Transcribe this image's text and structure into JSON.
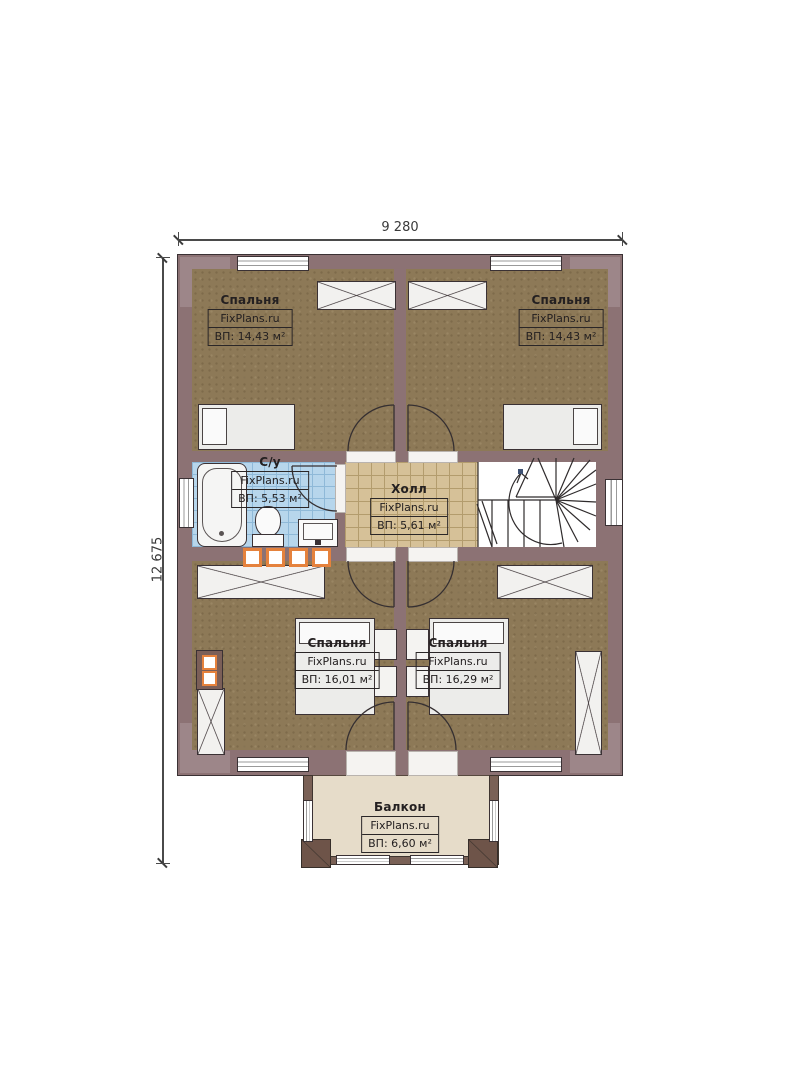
{
  "plan_title": "Second floor plan",
  "dimensions": {
    "top": "9 280",
    "left": "12 675"
  },
  "rooms": [
    {
      "key": "bedroom-top-left",
      "name": "Спальня",
      "brand": "FixPlans.ru",
      "area": "ВП: 14,43 м²"
    },
    {
      "key": "bedroom-top-right",
      "name": "Спальня",
      "brand": "FixPlans.ru",
      "area": "ВП: 14,43 м²"
    },
    {
      "key": "bathroom",
      "name": "С/у",
      "brand": "FixPlans.ru",
      "area": "ВП: 5,53 м²"
    },
    {
      "key": "hall",
      "name": "Холл",
      "brand": "FixPlans.ru",
      "area": "ВП: 5,61 м²"
    },
    {
      "key": "bedroom-bottom-left",
      "name": "Спальня",
      "brand": "FixPlans.ru",
      "area": "ВП: 16,01 м²"
    },
    {
      "key": "bedroom-bottom-right",
      "name": "Спальня",
      "brand": "FixPlans.ru",
      "area": "ВП: 16,29 м²"
    },
    {
      "key": "balcony",
      "name": "Балкон",
      "brand": "FixPlans.ru",
      "area": "ВП: 6,60 м²"
    }
  ],
  "colors": {
    "wall": "#8c7274",
    "wall_corner": "#9d8689",
    "floor_wood": "#8d7957",
    "floor_bath_tile": "#b7d6ec",
    "floor_hall_tile": "#d6c198",
    "balcony_floor": "#e6dcc9",
    "balcony_wall": "#7a6156",
    "accent_orange": "#e5823d",
    "line": "#3a3134"
  }
}
